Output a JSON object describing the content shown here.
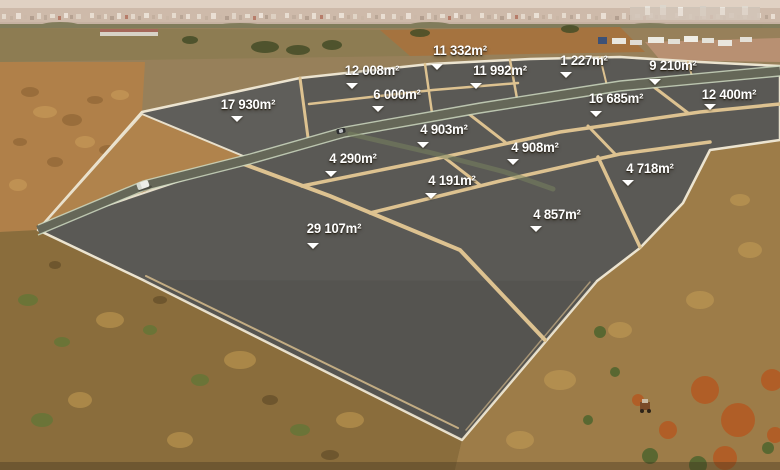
{
  "theme": {
    "plot_fill": "#5a5955",
    "divider_color": "#ddc290",
    "outer_border_color": "#ece4d0",
    "road_fill": "#656758",
    "road_edge_color": "#ccd8c0",
    "label_color": "#ffffff"
  },
  "plots": [
    {
      "area": "17 930m²",
      "label": {
        "x": 248,
        "y": 98
      },
      "pointer": {
        "x": 237,
        "y": 116
      }
    },
    {
      "area": "12 008m²",
      "label": {
        "x": 372,
        "y": 64
      },
      "pointer": {
        "x": 352,
        "y": 83
      }
    },
    {
      "area": "11 332m²",
      "label": {
        "x": 460,
        "y": 44
      },
      "pointer": {
        "x": 437,
        "y": 64
      }
    },
    {
      "area": "11 992m²",
      "label": {
        "x": 500,
        "y": 64
      },
      "pointer": {
        "x": 476,
        "y": 83
      }
    },
    {
      "area": "1 227m²",
      "label": {
        "x": 584,
        "y": 54
      },
      "pointer": {
        "x": 566,
        "y": 72
      }
    },
    {
      "area": "9 210m²",
      "label": {
        "x": 673,
        "y": 59
      },
      "pointer": {
        "x": 655,
        "y": 79
      }
    },
    {
      "area": "6 000m²",
      "label": {
        "x": 397,
        "y": 88
      },
      "pointer": {
        "x": 378,
        "y": 106
      }
    },
    {
      "area": "16 685m²",
      "label": {
        "x": 616,
        "y": 92
      },
      "pointer": {
        "x": 596,
        "y": 111
      }
    },
    {
      "area": "12 400m²",
      "label": {
        "x": 729,
        "y": 88
      },
      "pointer": {
        "x": 710,
        "y": 104
      }
    },
    {
      "area": "4 903m²",
      "label": {
        "x": 444,
        "y": 123
      },
      "pointer": {
        "x": 423,
        "y": 142
      }
    },
    {
      "area": "4 290m²",
      "label": {
        "x": 353,
        "y": 152
      },
      "pointer": {
        "x": 331,
        "y": 171
      }
    },
    {
      "area": "4 908m²",
      "label": {
        "x": 535,
        "y": 141
      },
      "pointer": {
        "x": 513,
        "y": 159
      }
    },
    {
      "area": "4 718m²",
      "label": {
        "x": 650,
        "y": 162
      },
      "pointer": {
        "x": 628,
        "y": 180
      }
    },
    {
      "area": "4 191m²",
      "label": {
        "x": 452,
        "y": 174
      },
      "pointer": {
        "x": 431,
        "y": 193
      }
    },
    {
      "area": "4 857m²",
      "label": {
        "x": 557,
        "y": 208
      },
      "pointer": {
        "x": 536,
        "y": 226
      }
    },
    {
      "area": "29 107m²",
      "label": {
        "x": 334,
        "y": 222
      },
      "pointer": {
        "x": 313,
        "y": 243
      }
    }
  ]
}
